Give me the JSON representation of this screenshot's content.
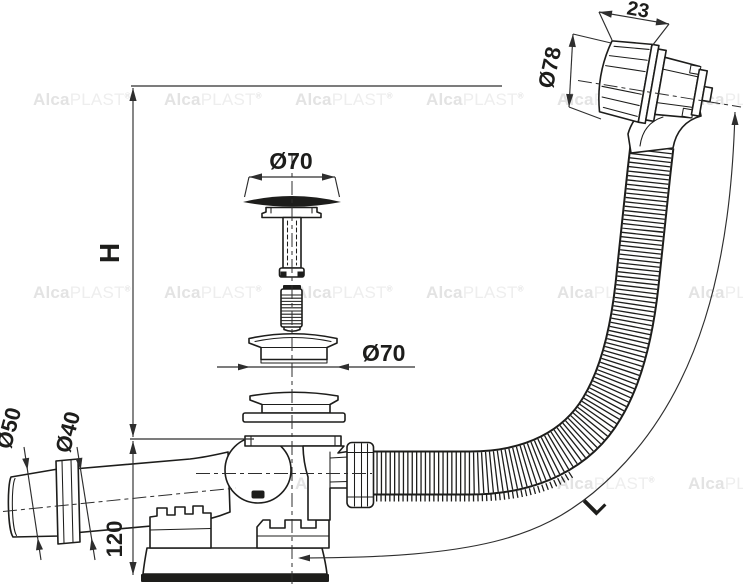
{
  "drawing": {
    "dimensions": {
      "installation_height": "H",
      "hose_length": "L",
      "overflow_head_depth": "23",
      "overflow_head_diameter": "Ø78",
      "plug_diameter": "Ø70",
      "waste_flange_diameter": "Ø70",
      "outlet_socket_diameter": "Ø50",
      "outlet_pipe_diameter": "Ø40",
      "waste_body_height": "120"
    },
    "watermark": {
      "brand_bold": "Alca",
      "brand_light": "PLAST",
      "registered_mark": "®"
    },
    "colors": {
      "background": "#ffffff",
      "line": "#1d1d1b",
      "dimension_line": "#2e2e2e",
      "watermark_bold": "#e3e3e3",
      "watermark_light": "#eeeeee"
    }
  }
}
